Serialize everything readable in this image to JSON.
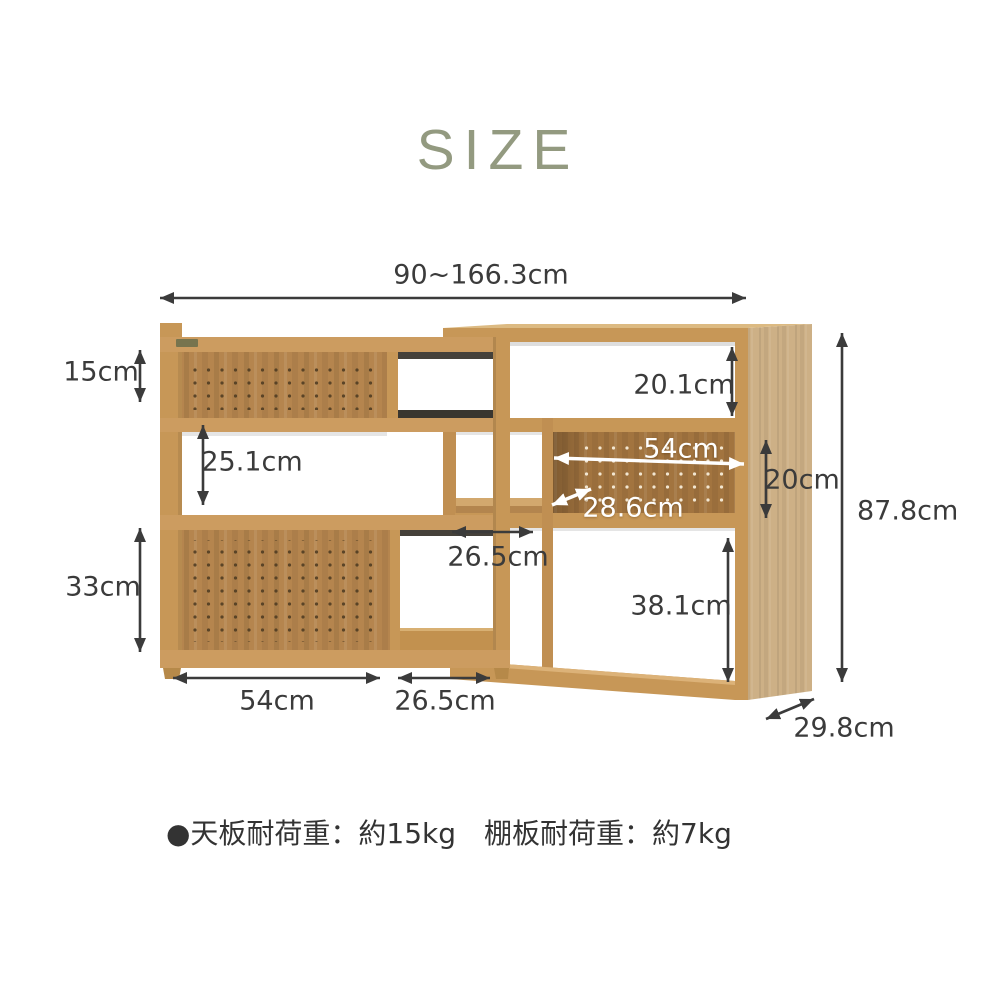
{
  "title": "SIZE",
  "dimensions": {
    "top_width": "90~166.3cm",
    "upper_left_shelf_height": "15cm",
    "middle_left_opening_height": "25.1cm",
    "lower_left_shelf_height": "33cm",
    "upper_right_opening_height": "20.1cm",
    "inner_shelf_width": "54cm",
    "inner_shelf_height": "20cm",
    "inner_shelf_depth": "28.6cm",
    "center_opening_width": "26.5cm",
    "lower_right_opening_height": "38.1cm",
    "bottom_left_width": "54cm",
    "bottom_center_width": "26.5cm",
    "total_height": "87.8cm",
    "total_depth": "29.8cm"
  },
  "note": "●天板耐荷重：約15kg　棚板耐荷重：約7kg",
  "colors": {
    "title_accent": "#939a80",
    "dimension_text": "#3b3b3b",
    "white_label": "#ffffff",
    "wood_front": "#c79757",
    "wood_board": "#cc9c60",
    "wood_pegboard_left": "#b5854e",
    "wood_pegboard_right": "#a2743f",
    "wood_side_panel": "#cdb086",
    "back_shadow": "#45413a"
  }
}
